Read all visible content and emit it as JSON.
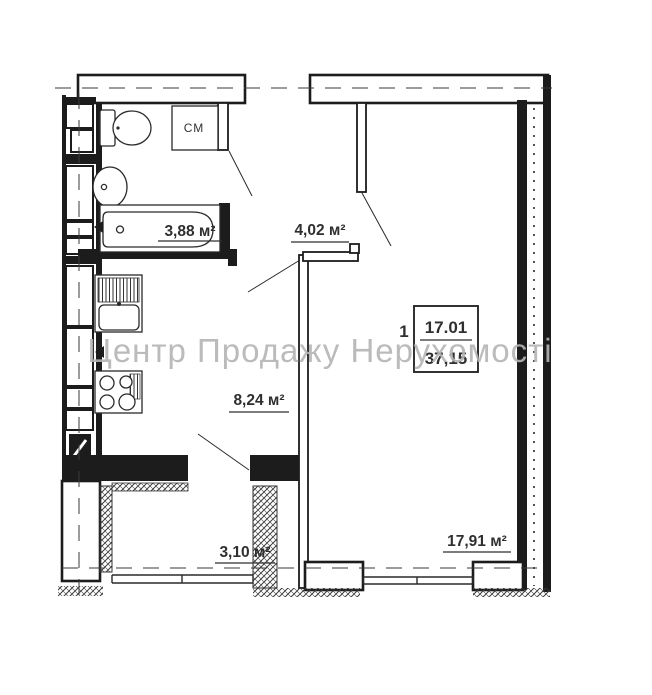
{
  "watermark": "Центр Продажу Нерухомості",
  "apartment_label": {
    "number": "1",
    "upper_value": "17.01",
    "lower_value": "37,15"
  },
  "rooms": {
    "bathroom": "3,88 м²",
    "hallway": "4,02 м²",
    "kitchen": "8,24 м²",
    "living_room": "17,91 м²",
    "balcony": "3,10 м²"
  },
  "fixtures": {
    "washing_machine_label": "СМ"
  },
  "colors": {
    "wall": "#1c1c1c",
    "text": "#2f2f2f",
    "watermark": "#b4b4b4",
    "background": "#ffffff"
  }
}
